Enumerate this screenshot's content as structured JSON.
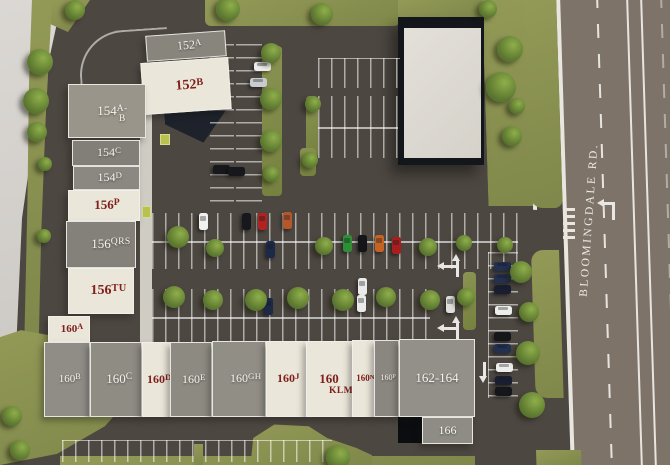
{
  "title": "Shopping center site plan",
  "road": {
    "label": "BLOOMINGDALE RD."
  },
  "colors": {
    "asphalt": "#4d4741",
    "road": "#7d7369",
    "grass": "#8b9252",
    "concrete": "#d7d4d0",
    "roof_gray": "#8c8981",
    "roof_cream": "#ebe6da",
    "label_red": "#7e201b",
    "label_white": "#f6f4ee"
  },
  "units": [
    {
      "id": "152A",
      "label": "152A",
      "roof": "gray",
      "tone": "#88857d",
      "x": 146,
      "y": 33,
      "w": 80,
      "h": 26,
      "fs": 12,
      "rot": -4
    },
    {
      "id": "152B",
      "label": "152B",
      "roof": "cream",
      "x": 142,
      "y": 60,
      "w": 88,
      "h": 52,
      "fs": 14,
      "rot": -4
    },
    {
      "id": "154A-B",
      "label": "154A-B",
      "roof": "gray",
      "tone": "#9a958a",
      "x": 68,
      "y": 84,
      "w": 78,
      "h": 54,
      "fs": 13,
      "rot": 0
    },
    {
      "id": "154C",
      "label": "154C",
      "roof": "gray",
      "tone": "#827f79",
      "x": 72,
      "y": 140,
      "w": 68,
      "h": 26,
      "fs": 12,
      "rot": 0
    },
    {
      "id": "154D",
      "label": "154D",
      "roof": "gray",
      "tone": "#8b8882",
      "x": 73,
      "y": 166,
      "w": 67,
      "h": 24,
      "fs": 12,
      "rot": 0
    },
    {
      "id": "156P",
      "label": "156P",
      "roof": "cream",
      "x": 68,
      "y": 190,
      "w": 72,
      "h": 31,
      "fs": 13,
      "rot": 0
    },
    {
      "id": "156QRS",
      "label": "156QRS",
      "roof": "gray",
      "tone": "#84817a",
      "x": 66,
      "y": 221,
      "w": 70,
      "h": 47,
      "fs": 13,
      "rot": 0
    },
    {
      "id": "156TU",
      "label": "156TU",
      "roof": "cream",
      "x": 68,
      "y": 268,
      "w": 66,
      "h": 46,
      "fs": 14,
      "rot": 0
    },
    {
      "id": "160A",
      "label": "160A",
      "roof": "cream",
      "x": 48,
      "y": 316,
      "w": 42,
      "h": 26,
      "fs": 11,
      "rot": 0
    },
    {
      "id": "160B",
      "label": "160B",
      "roof": "gray",
      "tone": "#908d87",
      "x": 44,
      "y": 342,
      "w": 46,
      "h": 75,
      "fs": 11,
      "rot": 0
    },
    {
      "id": "160C",
      "label": "160C",
      "roof": "gray",
      "tone": "#8f8c84",
      "x": 90,
      "y": 342,
      "w": 52,
      "h": 75,
      "fs": 13,
      "rot": 0
    },
    {
      "id": "160D",
      "label": "160D",
      "roof": "cream",
      "x": 142,
      "y": 342,
      "w": 28,
      "h": 75,
      "fs": 12,
      "rot": 0
    },
    {
      "id": "160E",
      "label": "160E",
      "roof": "gray",
      "tone": "#8d8a82",
      "x": 170,
      "y": 342,
      "w": 42,
      "h": 75,
      "fs": 12,
      "rot": 0
    },
    {
      "id": "160GH",
      "label": "160GH",
      "roof": "gray",
      "tone": "#918e86",
      "x": 212,
      "y": 341,
      "w": 54,
      "h": 76,
      "fs": 12,
      "rot": 0
    },
    {
      "id": "160J",
      "label": "160J",
      "roof": "cream",
      "x": 266,
      "y": 341,
      "w": 40,
      "h": 76,
      "fs": 12,
      "rot": 0
    },
    {
      "id": "160KLM",
      "label": "160\nKLM",
      "roof": "cream",
      "x": 306,
      "y": 341,
      "w": 46,
      "h": 76,
      "fs": 13,
      "rot": 0
    },
    {
      "id": "160N",
      "label": "160N",
      "roof": "cream",
      "x": 352,
      "y": 340,
      "w": 22,
      "h": 77,
      "fs": 9,
      "rot": 0
    },
    {
      "id": "160P",
      "label": "160P",
      "roof": "gray",
      "tone": "#8a8780",
      "x": 374,
      "y": 340,
      "w": 25,
      "h": 77,
      "fs": 8,
      "rot": 0
    },
    {
      "id": "162-164",
      "label": "162-164",
      "roof": "gray",
      "tone": "#93908a",
      "x": 399,
      "y": 339,
      "w": 76,
      "h": 78,
      "fs": 13,
      "rot": 0
    },
    {
      "id": "166",
      "label": "166",
      "roof": "gray",
      "tone": "#8f8c85",
      "x": 422,
      "y": 417,
      "w": 51,
      "h": 27,
      "fs": 12,
      "rot": 0
    }
  ],
  "parking_strips": [
    {
      "x": 210,
      "y": 44,
      "w": 24,
      "h": 158,
      "dir": "h"
    },
    {
      "x": 236,
      "y": 44,
      "w": 26,
      "h": 158,
      "dir": "h"
    },
    {
      "x": 318,
      "y": 58,
      "w": 82,
      "h": 30,
      "dir": "v",
      "edge": "top"
    },
    {
      "x": 318,
      "y": 96,
      "w": 80,
      "h": 62,
      "dir": "v",
      "mid": true
    },
    {
      "x": 152,
      "y": 213,
      "w": 366,
      "h": 56,
      "dir": "v",
      "mid": true
    },
    {
      "x": 152,
      "y": 289,
      "w": 278,
      "h": 56,
      "dir": "v",
      "mid": true
    },
    {
      "x": 488,
      "y": 252,
      "w": 30,
      "h": 146,
      "dir": "h",
      "edge": "left"
    },
    {
      "x": 62,
      "y": 440,
      "w": 270,
      "h": 22,
      "dir": "v",
      "edge": "top"
    }
  ],
  "islands": [
    [
      262,
      46,
      20,
      150
    ],
    [
      306,
      96,
      12,
      62
    ],
    [
      300,
      148,
      16,
      28
    ],
    [
      463,
      272,
      13,
      58
    ]
  ],
  "pads": [
    [
      160,
      134,
      10,
      11
    ],
    [
      142,
      206,
      9,
      12
    ]
  ],
  "trees": [
    [
      75,
      10,
      20
    ],
    [
      228,
      9,
      24
    ],
    [
      322,
      14,
      22
    ],
    [
      488,
      9,
      18
    ],
    [
      510,
      49,
      26
    ],
    [
      501,
      87,
      30
    ],
    [
      512,
      136,
      20
    ],
    [
      517,
      106,
      16
    ],
    [
      40,
      62,
      26
    ],
    [
      36,
      101,
      26
    ],
    [
      37,
      132,
      20
    ],
    [
      45,
      164,
      14
    ],
    [
      44,
      236,
      14
    ],
    [
      12,
      416,
      20
    ],
    [
      20,
      450,
      20
    ],
    [
      271,
      53,
      20
    ],
    [
      271,
      99,
      22
    ],
    [
      271,
      141,
      22
    ],
    [
      271,
      174,
      16
    ],
    [
      313,
      104,
      16
    ],
    [
      310,
      160,
      16
    ],
    [
      178,
      237,
      22
    ],
    [
      215,
      248,
      18
    ],
    [
      324,
      246,
      18
    ],
    [
      428,
      247,
      18
    ],
    [
      464,
      243,
      16
    ],
    [
      174,
      297,
      22
    ],
    [
      213,
      300,
      20
    ],
    [
      256,
      300,
      22
    ],
    [
      298,
      298,
      22
    ],
    [
      343,
      300,
      22
    ],
    [
      386,
      297,
      20
    ],
    [
      430,
      300,
      20
    ],
    [
      466,
      297,
      18
    ],
    [
      505,
      245,
      16
    ],
    [
      521,
      272,
      22
    ],
    [
      529,
      312,
      20
    ],
    [
      528,
      353,
      24
    ],
    [
      532,
      405,
      26
    ],
    [
      338,
      457,
      24
    ]
  ],
  "cars": [
    {
      "x": 262,
      "y": 66,
      "c": "#ededeb",
      "o": "h"
    },
    {
      "x": 258,
      "y": 82,
      "c": "#c9ccce",
      "o": "h"
    },
    {
      "x": 221,
      "y": 169,
      "c": "#17181c",
      "o": "h"
    },
    {
      "x": 236,
      "y": 171,
      "c": "#17181c",
      "o": "h"
    },
    {
      "x": 203,
      "y": 221,
      "c": "#f1f1ef",
      "o": "v"
    },
    {
      "x": 246,
      "y": 221,
      "c": "#17181c",
      "o": "v"
    },
    {
      "x": 262,
      "y": 221,
      "c": "#b02320",
      "o": "v"
    },
    {
      "x": 287,
      "y": 220,
      "c": "#b5562b",
      "o": "v"
    },
    {
      "x": 270,
      "y": 249,
      "c": "#1c2947",
      "o": "v"
    },
    {
      "x": 347,
      "y": 243,
      "c": "#2e8f36",
      "o": "v"
    },
    {
      "x": 362,
      "y": 243,
      "c": "#141519",
      "o": "v"
    },
    {
      "x": 379,
      "y": 243,
      "c": "#c46322",
      "o": "v"
    },
    {
      "x": 396,
      "y": 245,
      "c": "#a81e1c",
      "o": "v"
    },
    {
      "x": 268,
      "y": 306,
      "c": "#1c2947",
      "o": "v"
    },
    {
      "x": 362,
      "y": 286,
      "c": "#ebebe9",
      "o": "v"
    },
    {
      "x": 361,
      "y": 303,
      "c": "#ebebe9",
      "o": "v"
    },
    {
      "x": 450,
      "y": 304,
      "c": "#dededc",
      "o": "v"
    },
    {
      "x": 502,
      "y": 266,
      "c": "#233050",
      "o": "h"
    },
    {
      "x": 502,
      "y": 278,
      "c": "#233050",
      "o": "h"
    },
    {
      "x": 502,
      "y": 289,
      "c": "#191f31",
      "o": "h"
    },
    {
      "x": 503,
      "y": 310,
      "c": "#ededeb",
      "o": "h"
    },
    {
      "x": 502,
      "y": 336,
      "c": "#15161a",
      "o": "h"
    },
    {
      "x": 502,
      "y": 348,
      "c": "#233050",
      "o": "h"
    },
    {
      "x": 504,
      "y": 367,
      "c": "#ededeb",
      "o": "h"
    },
    {
      "x": 503,
      "y": 380,
      "c": "#191f31",
      "o": "h"
    },
    {
      "x": 503,
      "y": 391,
      "c": "#15161a",
      "o": "h"
    }
  ],
  "arrows": [
    {
      "t": "sl",
      "x": 441,
      "y": 256
    },
    {
      "t": "sl",
      "x": 441,
      "y": 318
    },
    {
      "t": "down",
      "x": 479,
      "y": 362
    },
    {
      "t": "lt",
      "x": 600,
      "y": 196
    }
  ]
}
